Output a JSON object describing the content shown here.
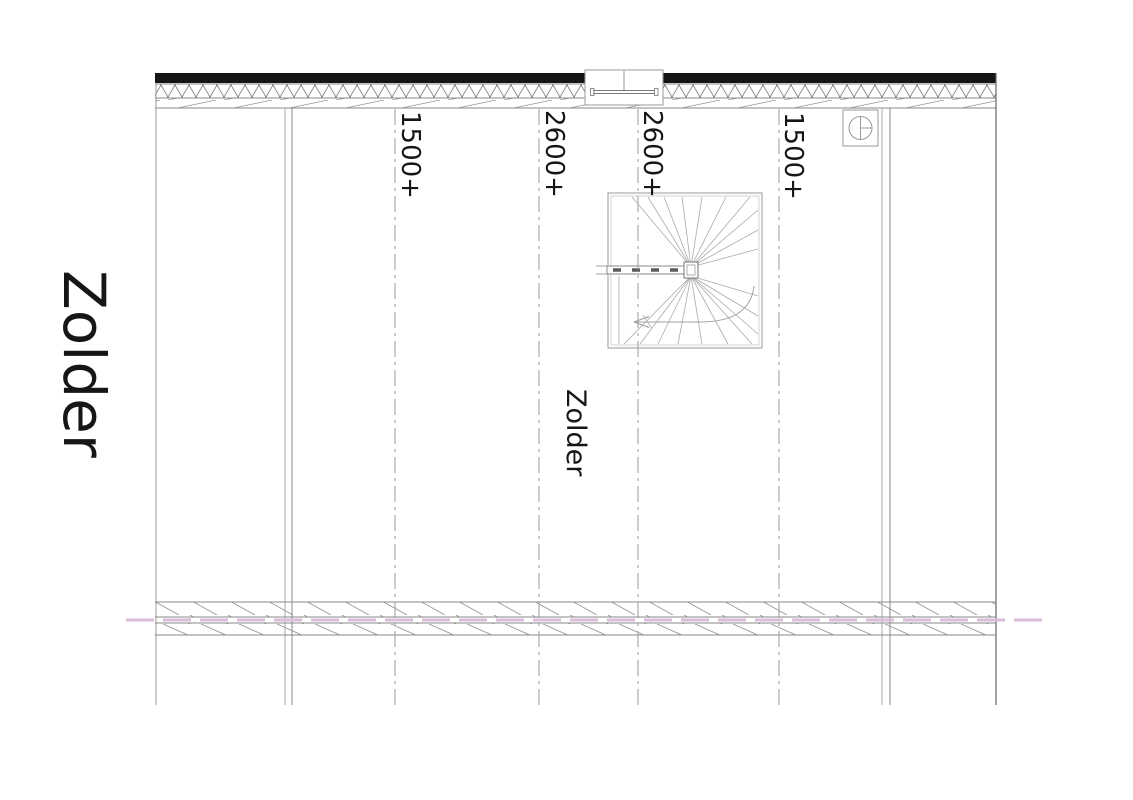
{
  "drawing": {
    "title": "Zolder",
    "room_label": "Zolder",
    "dimension_labels": [
      {
        "text": "1500+"
      },
      {
        "text": "2600+"
      },
      {
        "text": "2600+"
      },
      {
        "text": "1500+"
      }
    ],
    "symbols": {
      "stair": "winder-staircase-with-handrail-and-walkline-arrow",
      "top_center": "roof-window",
      "top_right": "ventilation-point"
    },
    "colors": {
      "wall_fill": "#151515",
      "line": "#8a8a8a",
      "light_line": "#b5b5b5",
      "dark_line": "#555555",
      "centerline_pink": "#d9bdd9",
      "text": "#161616",
      "background": "#ffffff"
    }
  }
}
